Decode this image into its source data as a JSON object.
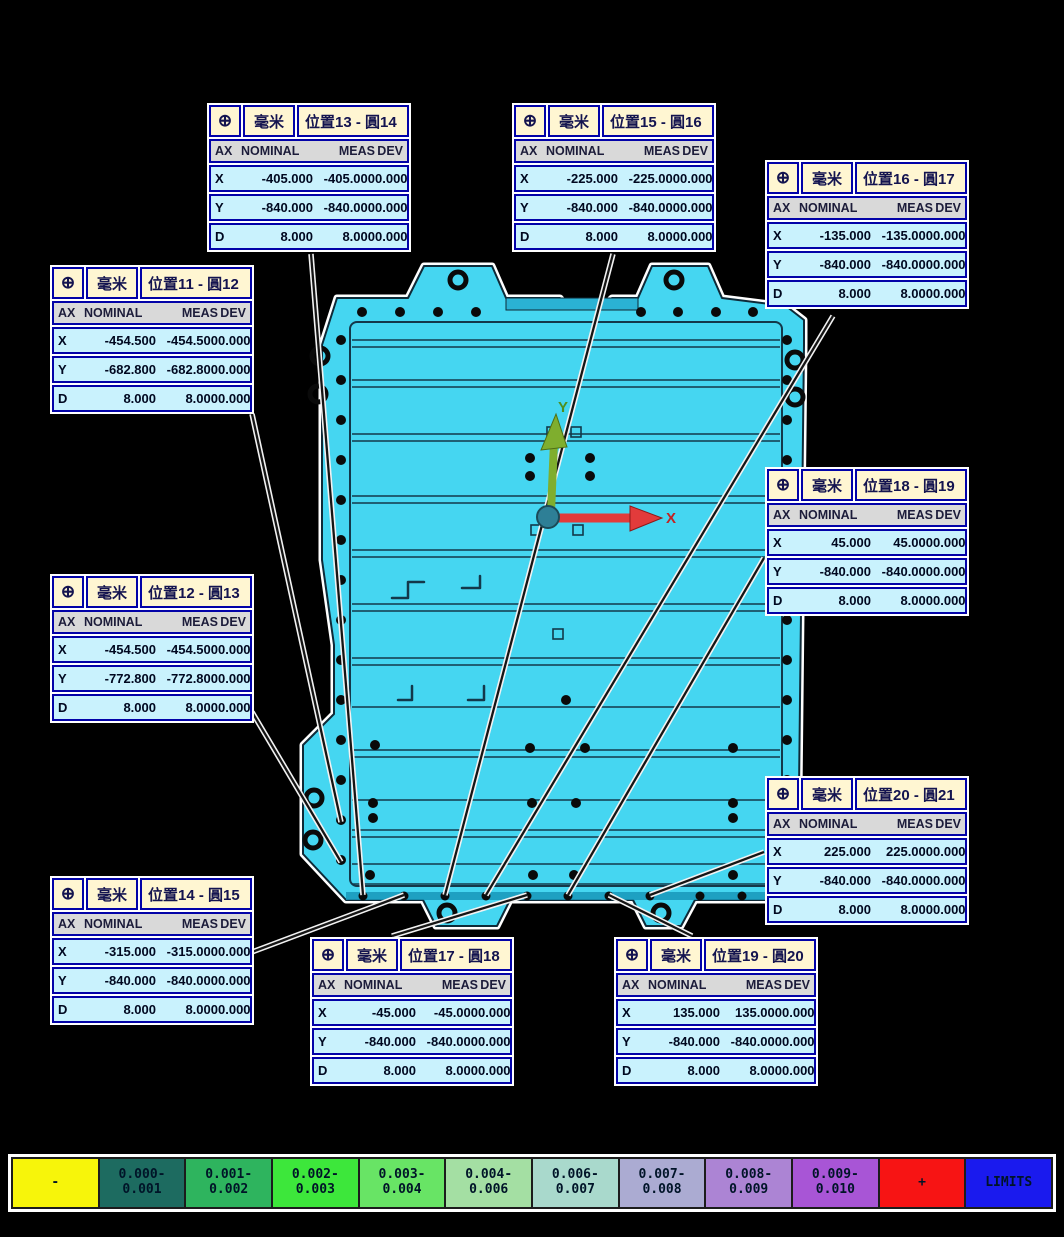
{
  "icons": {
    "position_feature": "⊕"
  },
  "columns": [
    "AX",
    "NOMINAL",
    "MEAS",
    "DEV"
  ],
  "axis": {
    "x": "X",
    "y": "Y"
  },
  "callouts": [
    {
      "id": "pos11",
      "unit": "毫米",
      "title": "位置11 - 圓12",
      "rows": [
        [
          "X",
          "-454.500",
          "-454.500",
          "0.000"
        ],
        [
          "Y",
          "-682.800",
          "-682.800",
          "0.000"
        ],
        [
          "D",
          "8.000",
          "8.000",
          "0.000"
        ]
      ]
    },
    {
      "id": "pos12",
      "unit": "毫米",
      "title": "位置12 - 圓13",
      "rows": [
        [
          "X",
          "-454.500",
          "-454.500",
          "0.000"
        ],
        [
          "Y",
          "-772.800",
          "-772.800",
          "0.000"
        ],
        [
          "D",
          "8.000",
          "8.000",
          "0.000"
        ]
      ]
    },
    {
      "id": "pos13",
      "unit": "毫米",
      "title": "位置13 - 圓14",
      "rows": [
        [
          "X",
          "-405.000",
          "-405.000",
          "0.000"
        ],
        [
          "Y",
          "-840.000",
          "-840.000",
          "0.000"
        ],
        [
          "D",
          "8.000",
          "8.000",
          "0.000"
        ]
      ]
    },
    {
      "id": "pos14",
      "unit": "毫米",
      "title": "位置14 - 圓15",
      "rows": [
        [
          "X",
          "-315.000",
          "-315.000",
          "0.000"
        ],
        [
          "Y",
          "-840.000",
          "-840.000",
          "0.000"
        ],
        [
          "D",
          "8.000",
          "8.000",
          "0.000"
        ]
      ]
    },
    {
      "id": "pos15",
      "unit": "毫米",
      "title": "位置15 - 圓16",
      "rows": [
        [
          "X",
          "-225.000",
          "-225.000",
          "0.000"
        ],
        [
          "Y",
          "-840.000",
          "-840.000",
          "0.000"
        ],
        [
          "D",
          "8.000",
          "8.000",
          "0.000"
        ]
      ]
    },
    {
      "id": "pos16",
      "unit": "毫米",
      "title": "位置16 - 圓17",
      "rows": [
        [
          "X",
          "-135.000",
          "-135.000",
          "0.000"
        ],
        [
          "Y",
          "-840.000",
          "-840.000",
          "0.000"
        ],
        [
          "D",
          "8.000",
          "8.000",
          "0.000"
        ]
      ]
    },
    {
      "id": "pos17",
      "unit": "毫米",
      "title": "位置17 - 圓18",
      "rows": [
        [
          "X",
          "-45.000",
          "-45.000",
          "0.000"
        ],
        [
          "Y",
          "-840.000",
          "-840.000",
          "0.000"
        ],
        [
          "D",
          "8.000",
          "8.000",
          "0.000"
        ]
      ]
    },
    {
      "id": "pos18",
      "unit": "毫米",
      "title": "位置18 - 圓19",
      "rows": [
        [
          "X",
          "45.000",
          "45.000",
          "0.000"
        ],
        [
          "Y",
          "-840.000",
          "-840.000",
          "0.000"
        ],
        [
          "D",
          "8.000",
          "8.000",
          "0.000"
        ]
      ]
    },
    {
      "id": "pos19",
      "unit": "毫米",
      "title": "位置19 - 圓20",
      "rows": [
        [
          "X",
          "135.000",
          "135.000",
          "0.000"
        ],
        [
          "Y",
          "-840.000",
          "-840.000",
          "0.000"
        ],
        [
          "D",
          "8.000",
          "8.000",
          "0.000"
        ]
      ]
    },
    {
      "id": "pos20",
      "unit": "毫米",
      "title": "位置20 - 圓21",
      "rows": [
        [
          "X",
          "225.000",
          "225.000",
          "0.000"
        ],
        [
          "Y",
          "-840.000",
          "-840.000",
          "0.000"
        ],
        [
          "D",
          "8.000",
          "8.000",
          "0.000"
        ]
      ]
    }
  ],
  "legend": [
    {
      "label": "-",
      "color": "#F7F50A"
    },
    {
      "label": "0.000-\n0.001",
      "color": "#1D6B60"
    },
    {
      "label": "0.001-\n0.002",
      "color": "#2EB45E"
    },
    {
      "label": "0.002-\n0.003",
      "color": "#3DE73B"
    },
    {
      "label": "0.003-\n0.004",
      "color": "#68E465"
    },
    {
      "label": "0.004-\n0.006",
      "color": "#A4DFA3"
    },
    {
      "label": "0.006-\n0.007",
      "color": "#A9D9CC"
    },
    {
      "label": "0.007-\n0.008",
      "color": "#ABABD2"
    },
    {
      "label": "0.008-\n0.009",
      "color": "#AC84D4"
    },
    {
      "label": "0.009-\n0.010",
      "color": "#A855D6"
    },
    {
      "label": "+",
      "color": "#F71414"
    },
    {
      "label": "LIMITS",
      "color": "#1A1AEE"
    }
  ],
  "part_colors": {
    "body": "#45D6F1",
    "outline": "#0E2A38",
    "accent_dark": "#2AB2D4"
  }
}
